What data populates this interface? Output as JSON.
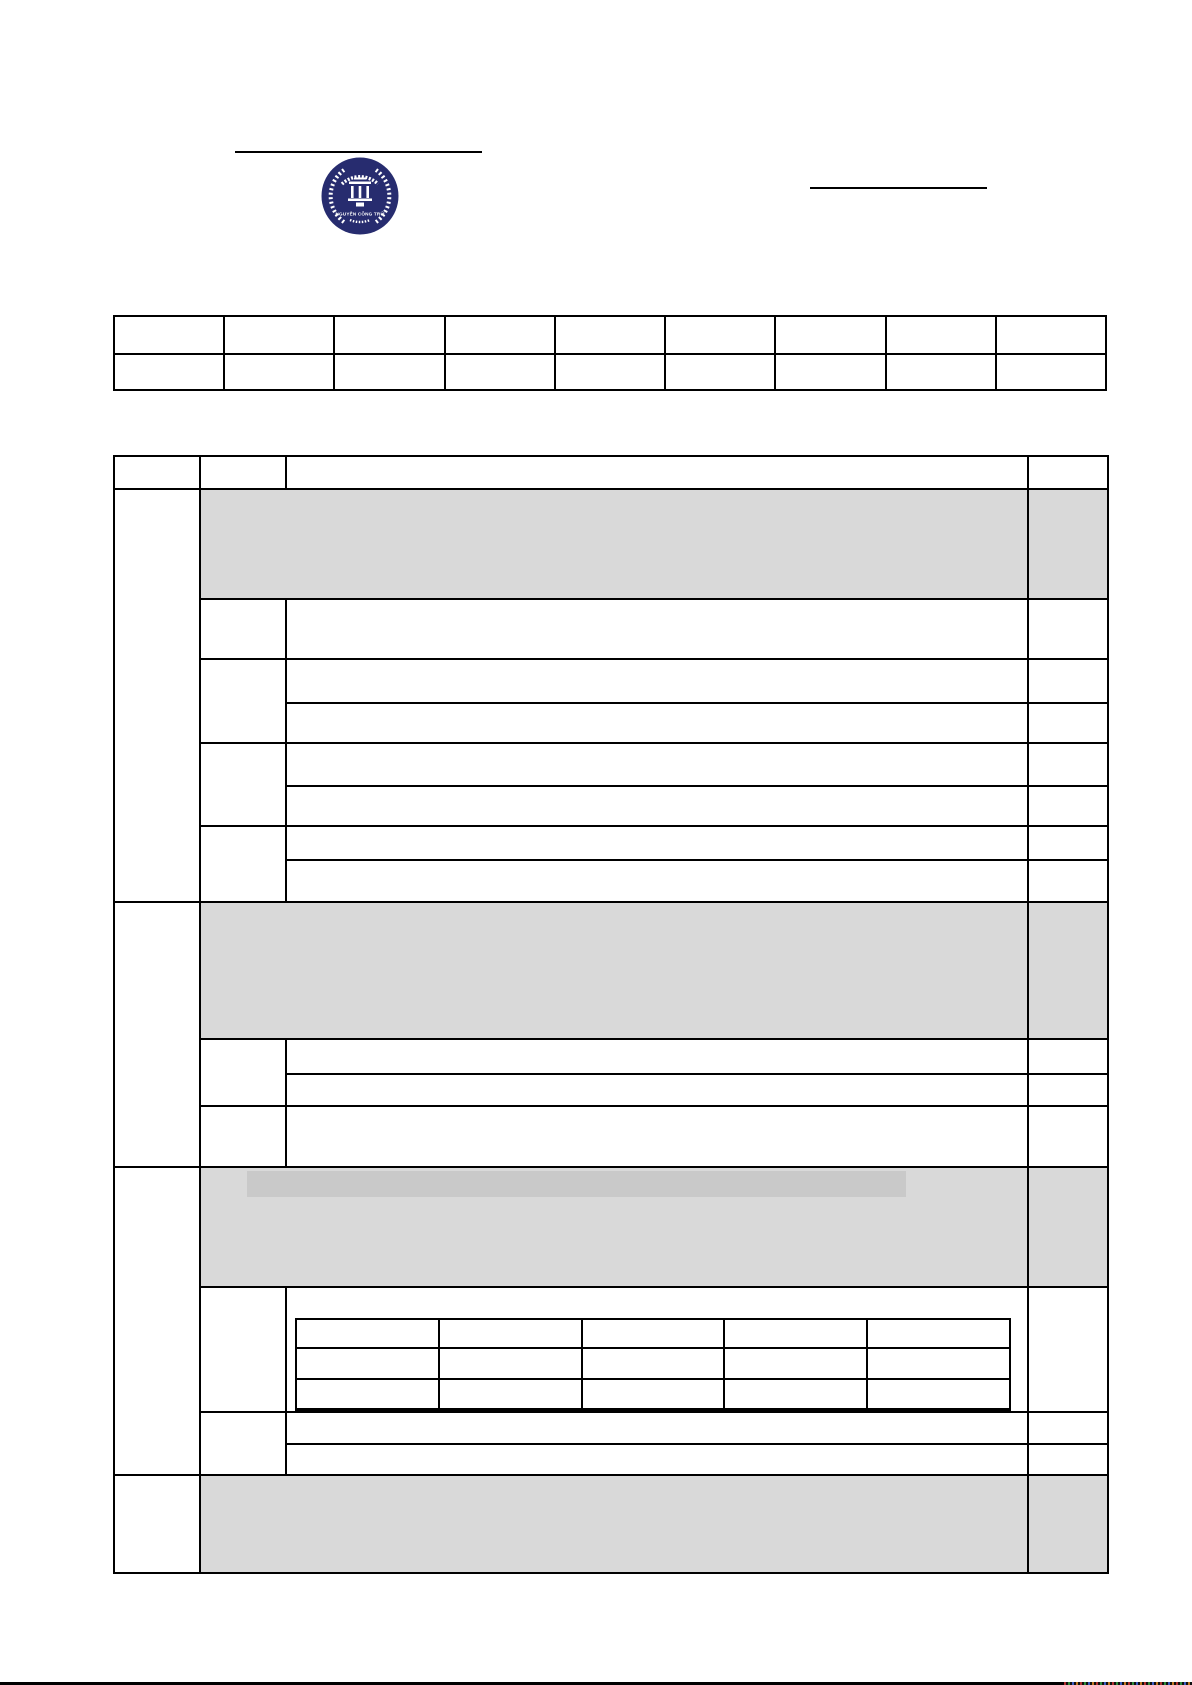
{
  "document": {
    "kind": "blank-school-form-page",
    "all_visible_cells_empty": true
  },
  "logo": {
    "school_name": "NGUYỄN CÔNG TRỨ",
    "shape": "circular-school-emblem-with-laurel-wreath-and-temple",
    "color": "#272c6f",
    "foreground": "#ffffff"
  },
  "colors": {
    "page_background": "#ffffff",
    "table_border": "#000000",
    "shaded_band": "#d9d9d9",
    "highlight_bar": "#c9c9c9",
    "bottom_strip": "#000000"
  },
  "top_table": {
    "rows": 2,
    "columns": 9,
    "cells_empty": true
  },
  "main_table": {
    "columns": 4,
    "column_widths_px": [
      86,
      86,
      742,
      80
    ],
    "sections": 4,
    "shaded_band_rows": 4,
    "cells_empty": true
  },
  "inner_table": {
    "rows": 3,
    "columns": 5,
    "cells_empty": true
  }
}
